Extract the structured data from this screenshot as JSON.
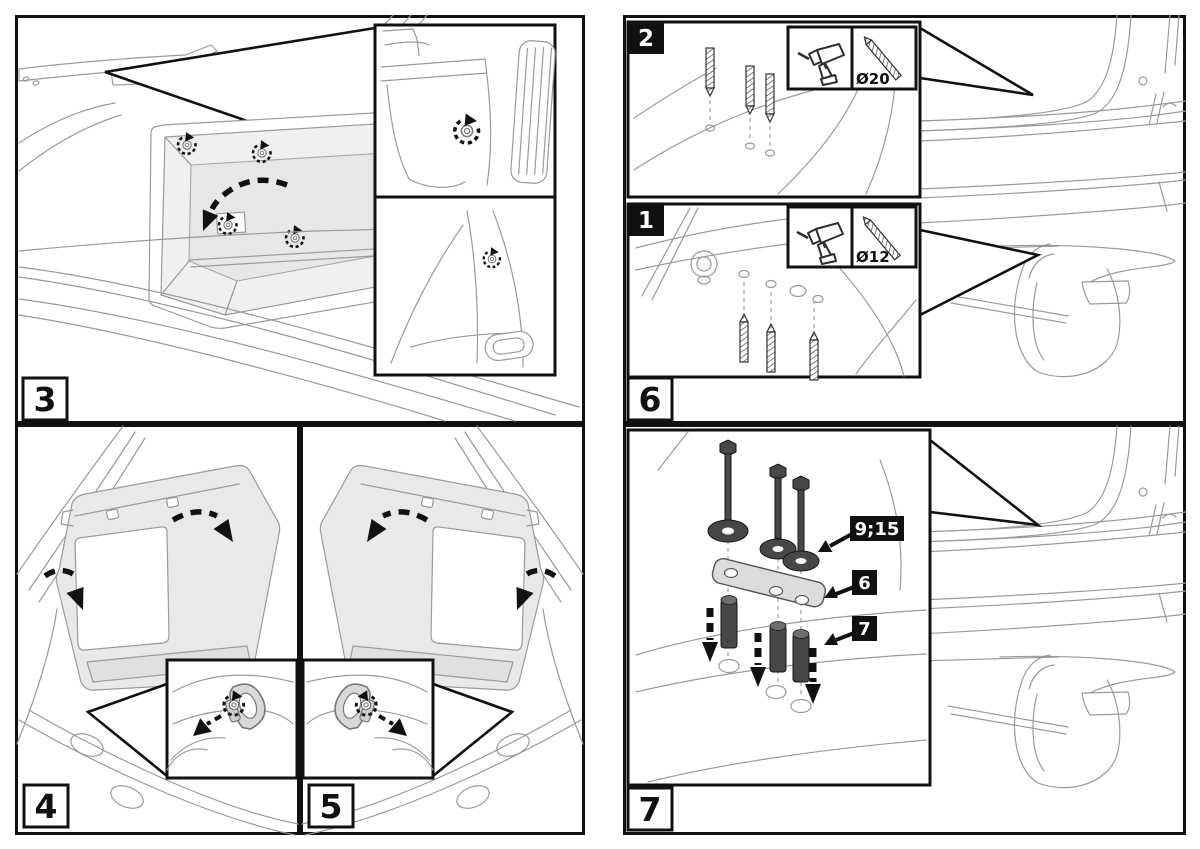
{
  "document": {
    "type": "illustrated-installation-instructions",
    "background": "#ffffff"
  },
  "colors": {
    "panel_border": "#111111",
    "line_art": "#9a9a9a",
    "trim_fill": "#e9e9e9",
    "hardware_fill": "#474747",
    "plate_fill": "#dcdcdc",
    "label_bg_dark": "#111111",
    "label_text_light": "#ffffff"
  },
  "panels": {
    "step3": {
      "label": "3"
    },
    "step4": {
      "label": "4"
    },
    "step5": {
      "label": "5"
    },
    "step6": {
      "label": "6",
      "sub_steps": [
        {
          "label": "2",
          "drill_diameter": "Ø20"
        },
        {
          "label": "1",
          "drill_diameter": "Ø12"
        }
      ]
    },
    "step7": {
      "label": "7",
      "callouts": [
        {
          "label": "9;15"
        },
        {
          "label": "6"
        },
        {
          "label": "7"
        }
      ]
    }
  }
}
